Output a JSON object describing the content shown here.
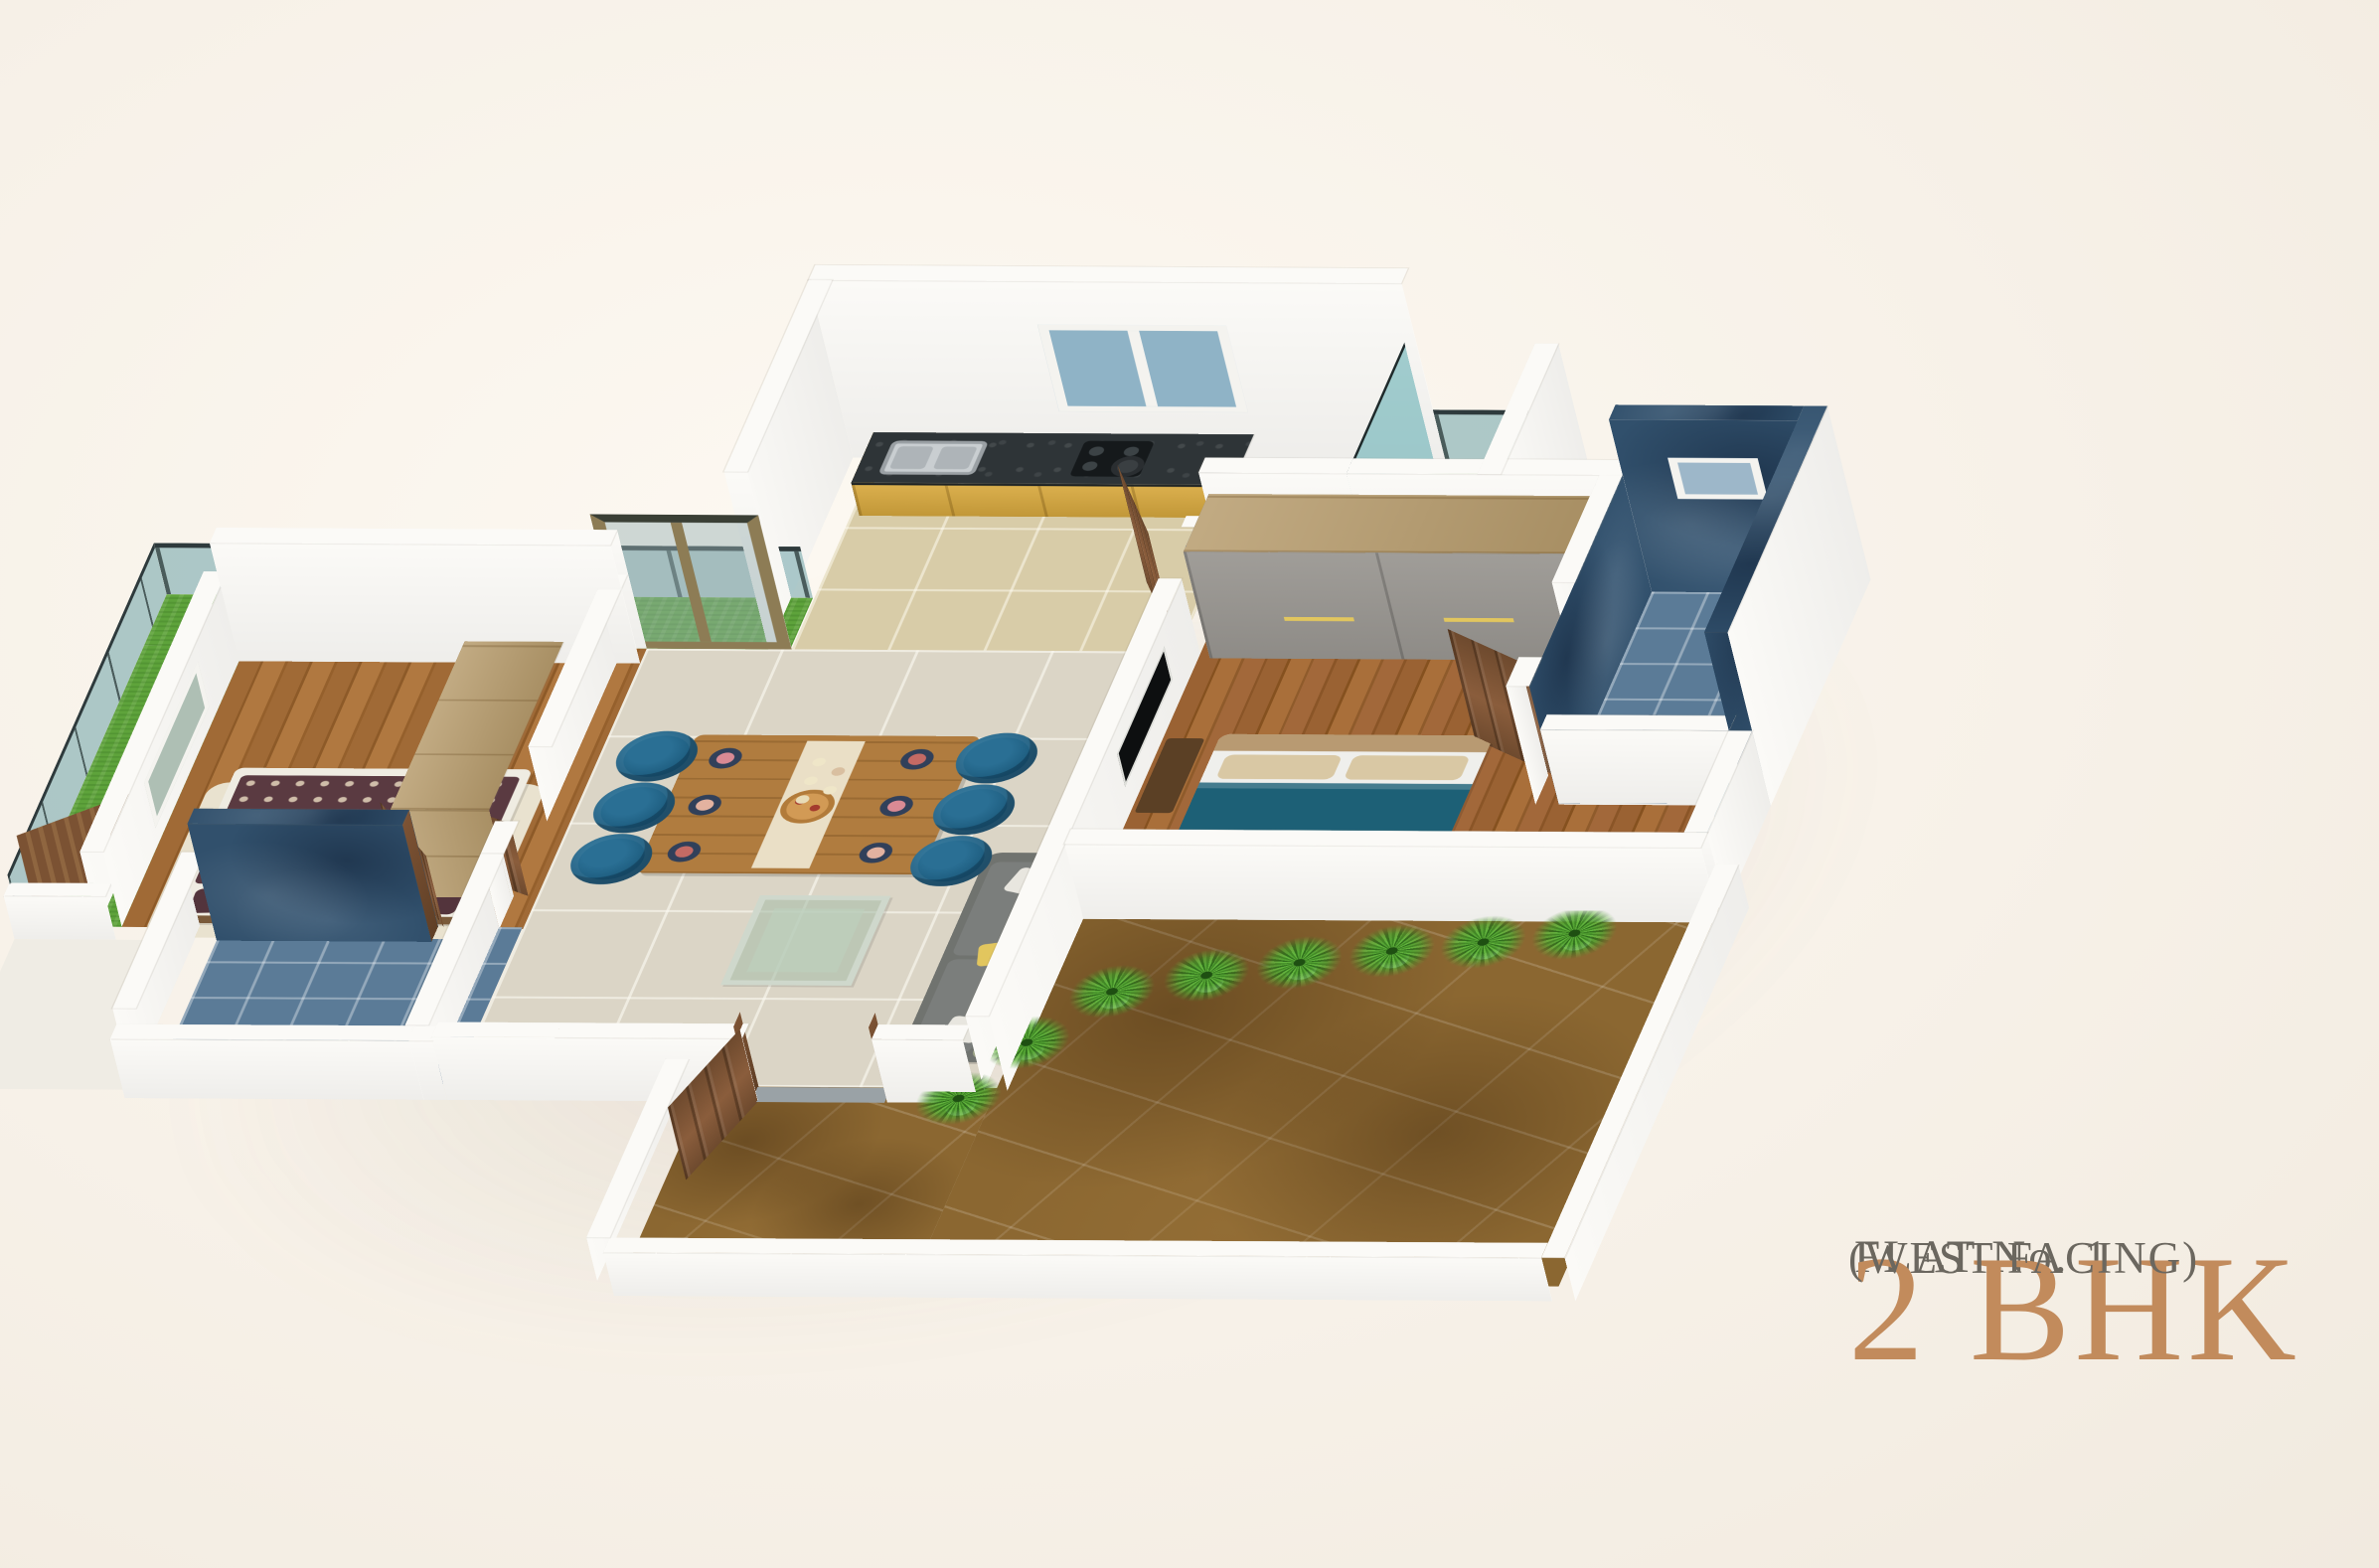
{
  "title_block": {
    "flat_label": "FLAT No. 1",
    "bhk_label": "2 BHK",
    "facing_label": "(WEST FACING)"
  },
  "palette": {
    "background": "#f6f0e7",
    "text_gray": "#6b675f",
    "accent_tan": "#c28b5c",
    "wall_white": "#fbfaf7",
    "wall_shade": "#efece4",
    "tile_cream": "#dbd5c6",
    "kitchen_floor": "#d8cca8",
    "wood_floor": "#99622f",
    "counter_dark": "#2e3437",
    "cabinet_yellow": "#d7a83e",
    "chair_teal": "#1d5c7e",
    "table_wood": "#b07c3f",
    "sofa_gray": "#70736f",
    "cushion_olive": "#9aa183",
    "pillow_yellow": "#e2c65e",
    "bed_teal": "#1d6076",
    "headboard_tan": "#c8b189",
    "spread_maroon": "#5a3a41",
    "rug_cream": "#e9e2cf",
    "marble_blue_dark": "#31506c",
    "bath_tile_blue": "#5b7b97",
    "turf_green": "#5ea33b",
    "terrace_brown": "#8b6731",
    "glass_teal": "rgba(110,162,168,0.55)",
    "rail_dark": "#2e3a3c",
    "window_blue": "#8fb3c6",
    "door_wood": "#7b5233",
    "pot_white": "#f2f1ec",
    "text_gray_dark": "#5f5b55"
  },
  "plan": {
    "type": "isometric-3d-floor-plan",
    "unit": "2 BHK apartment",
    "rooms": [
      {
        "name": "kitchen",
        "floor": "beige-tile",
        "features": [
          "granite-counter",
          "steel-sink",
          "hob-with-pan",
          "yellow-cabinets",
          "back-window"
        ]
      },
      {
        "name": "living-dining",
        "floor": "cream-tile",
        "features": [
          "wooden-dining-table",
          "six-teal-chairs",
          "grey-sofa-yellow-pillows",
          "glass-coffee-table",
          "sliding-glass-door",
          "entrance-door"
        ]
      },
      {
        "name": "master-bedroom",
        "floor": "wood-plank",
        "features": [
          "double-bed-teal-blanket",
          "grey-wardrobe",
          "wall-tv",
          "side-window"
        ]
      },
      {
        "name": "master-bathroom",
        "floor": "blue-tile",
        "features": [
          "dark-blue-marble-walls",
          "ventilation-window",
          "wooden-door"
        ]
      },
      {
        "name": "second-bedroom",
        "floor": "wood-plank",
        "features": [
          "double-bed-patterned-spread",
          "cream-rug",
          "wood-dresser",
          "balcony-door",
          "window"
        ]
      },
      {
        "name": "second-bathroom",
        "floor": "blue-tile",
        "features": [
          "dark-blue-marble-accent-wall",
          "wooden-door"
        ]
      },
      {
        "name": "utility-wash",
        "floor": "pale-tile",
        "features": [
          "wash-basin",
          "teal-glass-screen",
          "turf-strip"
        ]
      },
      {
        "name": "rear-balcony",
        "floor": "artificial-turf",
        "features": [
          "teal-glass-railing"
        ]
      },
      {
        "name": "terrace",
        "floor": "brown-marble",
        "features": [
          "potted-palm-row",
          "white-parapet"
        ]
      }
    ]
  }
}
